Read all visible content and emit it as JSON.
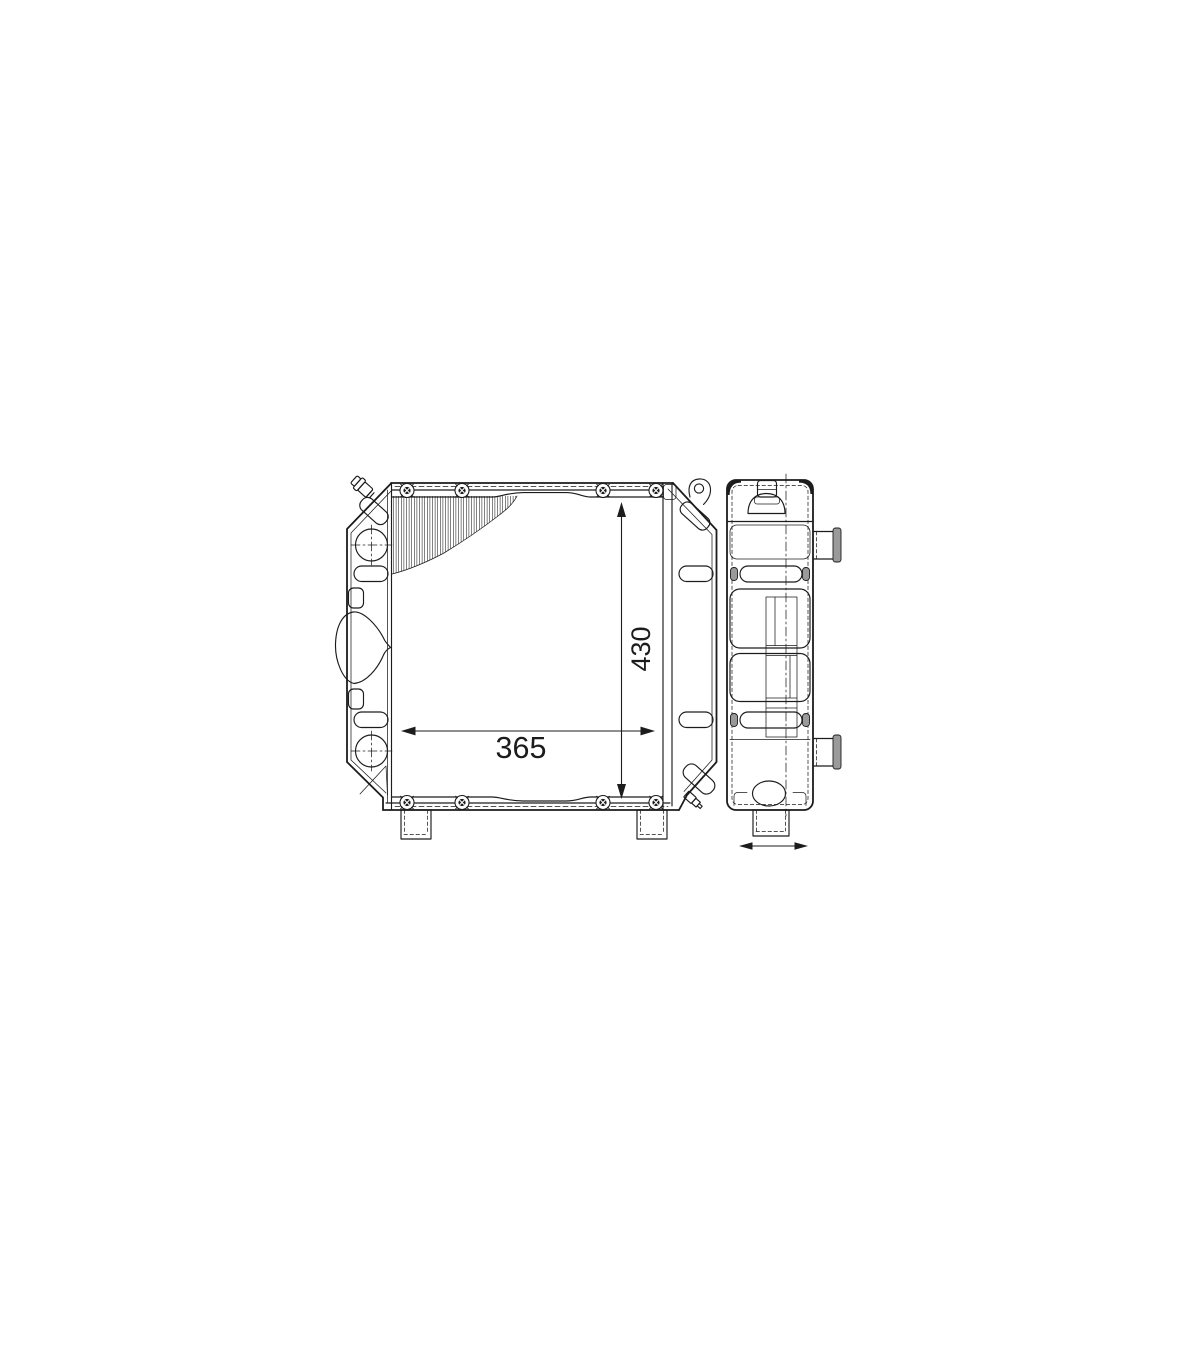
{
  "page": {
    "background_color": "#ffffff"
  },
  "drawing": {
    "line_color": "#1c1c1c",
    "gray_fill_color": "#9a9a9a",
    "dimensions": {
      "height_label": "430",
      "width_label": "365"
    }
  }
}
